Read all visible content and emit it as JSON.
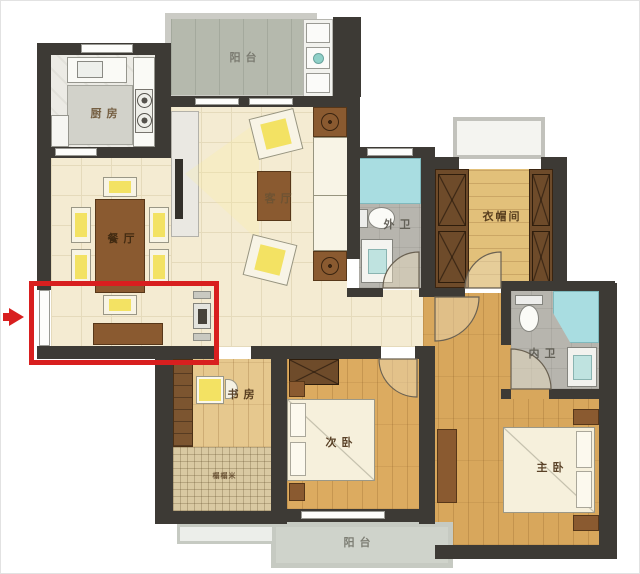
{
  "rooms": {
    "kitchen": {
      "label": "厨房"
    },
    "balcony_top": {
      "label": "阳台"
    },
    "living_room": {
      "label": "客厅"
    },
    "dining_room": {
      "label": "餐厅"
    },
    "guest_bathroom": {
      "label": "外卫"
    },
    "cloakroom": {
      "label": "衣帽间"
    },
    "inner_bathroom": {
      "label": "内卫"
    },
    "study": {
      "label": "书房"
    },
    "tatami_area": {
      "label": "榻榻米"
    },
    "second_bedroom": {
      "label": "次卧"
    },
    "master_bedroom": {
      "label": "主卧"
    },
    "balcony_bottom": {
      "label": "阳台"
    }
  },
  "annotation": {
    "highlight_color": "#d81f1f",
    "arrow_color": "#d81f1f"
  },
  "colors": {
    "wall": "#3d3a35",
    "tile_floor": "#f4ebd2",
    "wood_floor": "#dcab60",
    "bath_floor": "#b7b5ae",
    "shower": "#a9dde1",
    "balcony_floor": "#b5b9ad",
    "furniture_brown": "#8a5a30"
  }
}
